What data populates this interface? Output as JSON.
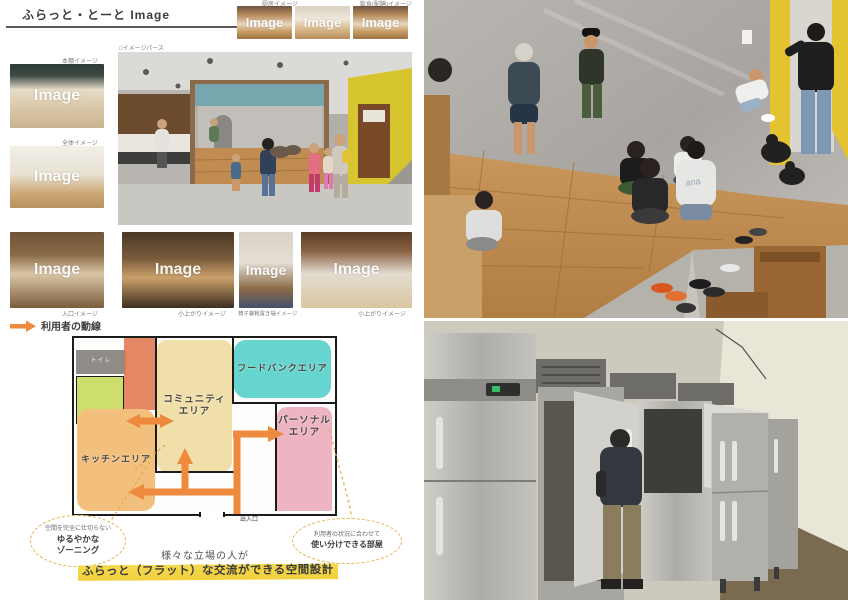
{
  "title": "ふらっと・とーと Image",
  "watermark": "Image",
  "section_labels": {
    "perspective": "□イメージパース",
    "flow_legend": "利用者の動線"
  },
  "top_row": {
    "items": [
      {
        "label": "厨房イメージ"
      },
      {
        "label": ""
      },
      {
        "label": "飲食(配膳)イメージ"
      }
    ]
  },
  "left_column": {
    "items": [
      {
        "label": "本棚イメージ"
      },
      {
        "label": "全体イメージ"
      }
    ]
  },
  "bottom_row": {
    "items": [
      {
        "label": "入口イメージ"
      },
      {
        "label": "小上がりイメージ"
      },
      {
        "label": "椅子兼靴置き場イメージ"
      },
      {
        "label": "小上がりイメージ"
      }
    ]
  },
  "floorplan": {
    "zones": {
      "community": {
        "line1": "コミュニティ",
        "line2": "エリア"
      },
      "foodbank": {
        "line1": "フードバンクエリア"
      },
      "personal": {
        "line1": "パーソナル",
        "line2": "エリア"
      },
      "kitchen": {
        "line1": "キッチンエリア"
      }
    },
    "room_labels": {
      "toilet": "トイレ",
      "entrance": "出入口"
    }
  },
  "callouts": {
    "left": {
      "line1": "空間を完全に仕切らない",
      "line2": "ゆるやかな",
      "line3": "ゾーニング"
    },
    "right": {
      "line1": "利用者の状況に合わせて",
      "line2": "使い分けできる部屋"
    }
  },
  "summary": {
    "lead": "様々な立場の人が",
    "highlight": "ふらっと（フラット）な交流ができる空間設計"
  },
  "colors": {
    "accent_orange": "#ee8a3e",
    "marker_yellow": "#f4d94f",
    "zone_community": "#f0dfa9",
    "zone_foodbank": "#66d4cf",
    "zone_personal": "#eeb4c2",
    "zone_kitchen": "#f3bf7d",
    "zone_toilet": "#8f8c87",
    "zone_vestibule": "#e0764e",
    "zone_washroom": "#cede6e"
  }
}
